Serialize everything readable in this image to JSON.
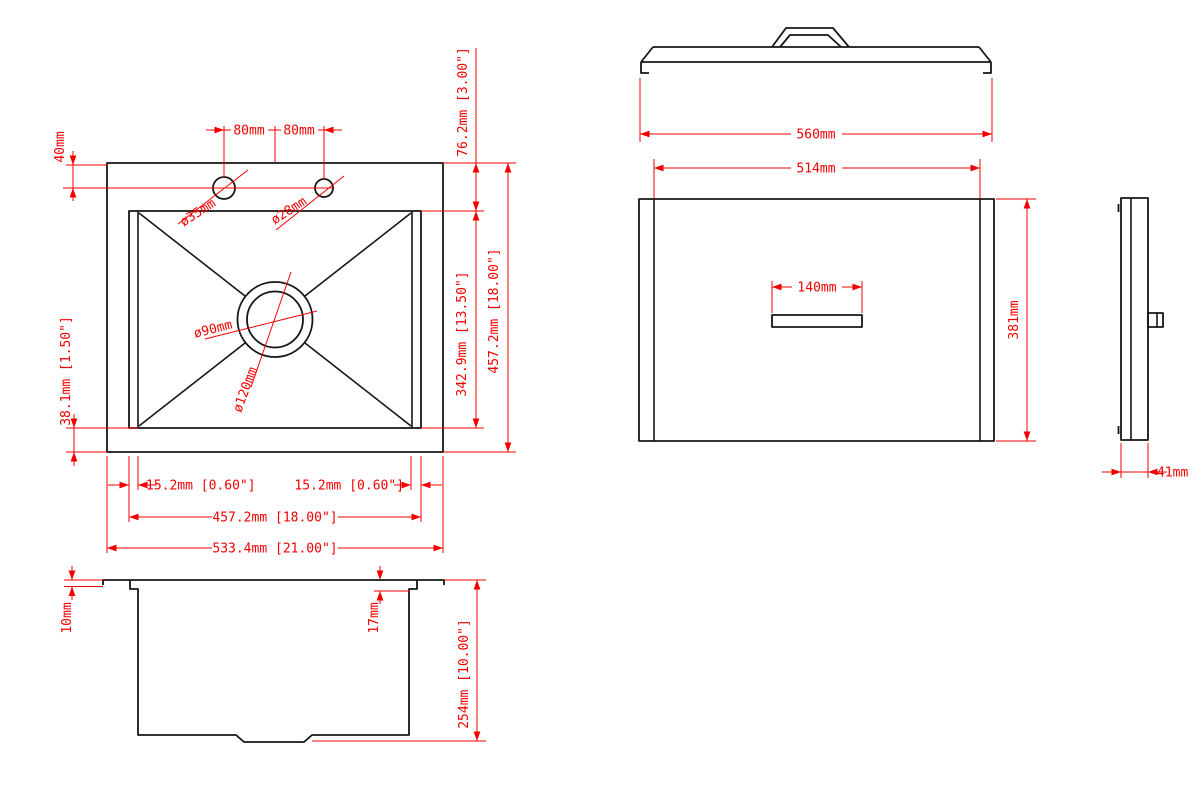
{
  "meta": {
    "drawing_type": "sink-dimension-drawing",
    "background_color": "#ffffff",
    "outline_color": "#161616",
    "dimension_color": "#f20000"
  },
  "views": {
    "sink_top": {
      "dims": {
        "hole_spacing_left": "80mm",
        "hole_spacing_right": "80mm",
        "hole_offset": "40mm",
        "hole_left_diameter": "ø35mm",
        "hole_right_diameter": "ø28mm",
        "drain_inner_diameter": "ø90mm",
        "drain_outer_diameter": "ø120mm",
        "rim_to_bowl": "76.2mm [3.00\"]",
        "bowl_length": "342.9mm [13.50\"]",
        "overall_length": "457.2mm [18.00\"]",
        "bowl_edge_margin": "38.1mm [1.50\"]",
        "corner_left": "15.2mm [0.60\"]",
        "corner_right": "15.2mm [0.60\"]",
        "bowl_width": "457.2mm [18.00\"]",
        "overall_width": "533.4mm [21.00\"]"
      }
    },
    "sink_section": {
      "dims": {
        "rim_height": "10mm",
        "lip_height": "17mm",
        "bowl_depth": "254mm [10.00\"]"
      }
    },
    "lid": {
      "dims": {
        "overall_width": "560mm",
        "top_width": "514mm",
        "handle_width": "140mm",
        "depth": "381mm",
        "thickness": "41mm"
      }
    }
  }
}
